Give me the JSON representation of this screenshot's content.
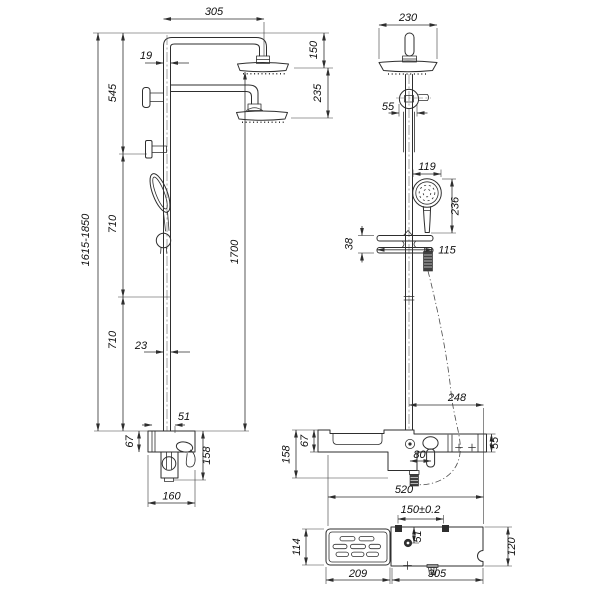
{
  "drawing": {
    "type": "technical-dimension-drawing",
    "subject": "shower-column-with-dual-overhead-showers-hand-shower-and-shelf-mixer",
    "colors": {
      "background": "#ffffff",
      "line": "#2e2e2e",
      "text": "#101010"
    }
  },
  "dims": {
    "front": {
      "arm_span": "305",
      "pipe_top": "19",
      "top_to_bracket": "545",
      "head1_drop": "150",
      "head2_drop": "235",
      "overall_range": "1615-1850",
      "seg_upper": "710",
      "seg_lower": "710",
      "riser_length": "1700",
      "pipe_lower": "23",
      "body_offset": "51",
      "body_top_height": "67",
      "body_height": "158",
      "body_width": "160"
    },
    "side": {
      "head_width": "230",
      "bracket_width": "55",
      "hand_shower_dia": "119",
      "hand_shower_len": "236",
      "slider_height": "38",
      "slider_width": "115",
      "right_span": "248",
      "body_top_height": "67",
      "body_height": "158",
      "handle_offset": "80",
      "end_height": "55",
      "body_width": "520",
      "hole_pitch": "150±0.2"
    },
    "bottom": {
      "tray_depth": "114",
      "hole_inset": "51",
      "tray_width": "209",
      "plate_width": "305",
      "plate_depth": "120"
    }
  }
}
